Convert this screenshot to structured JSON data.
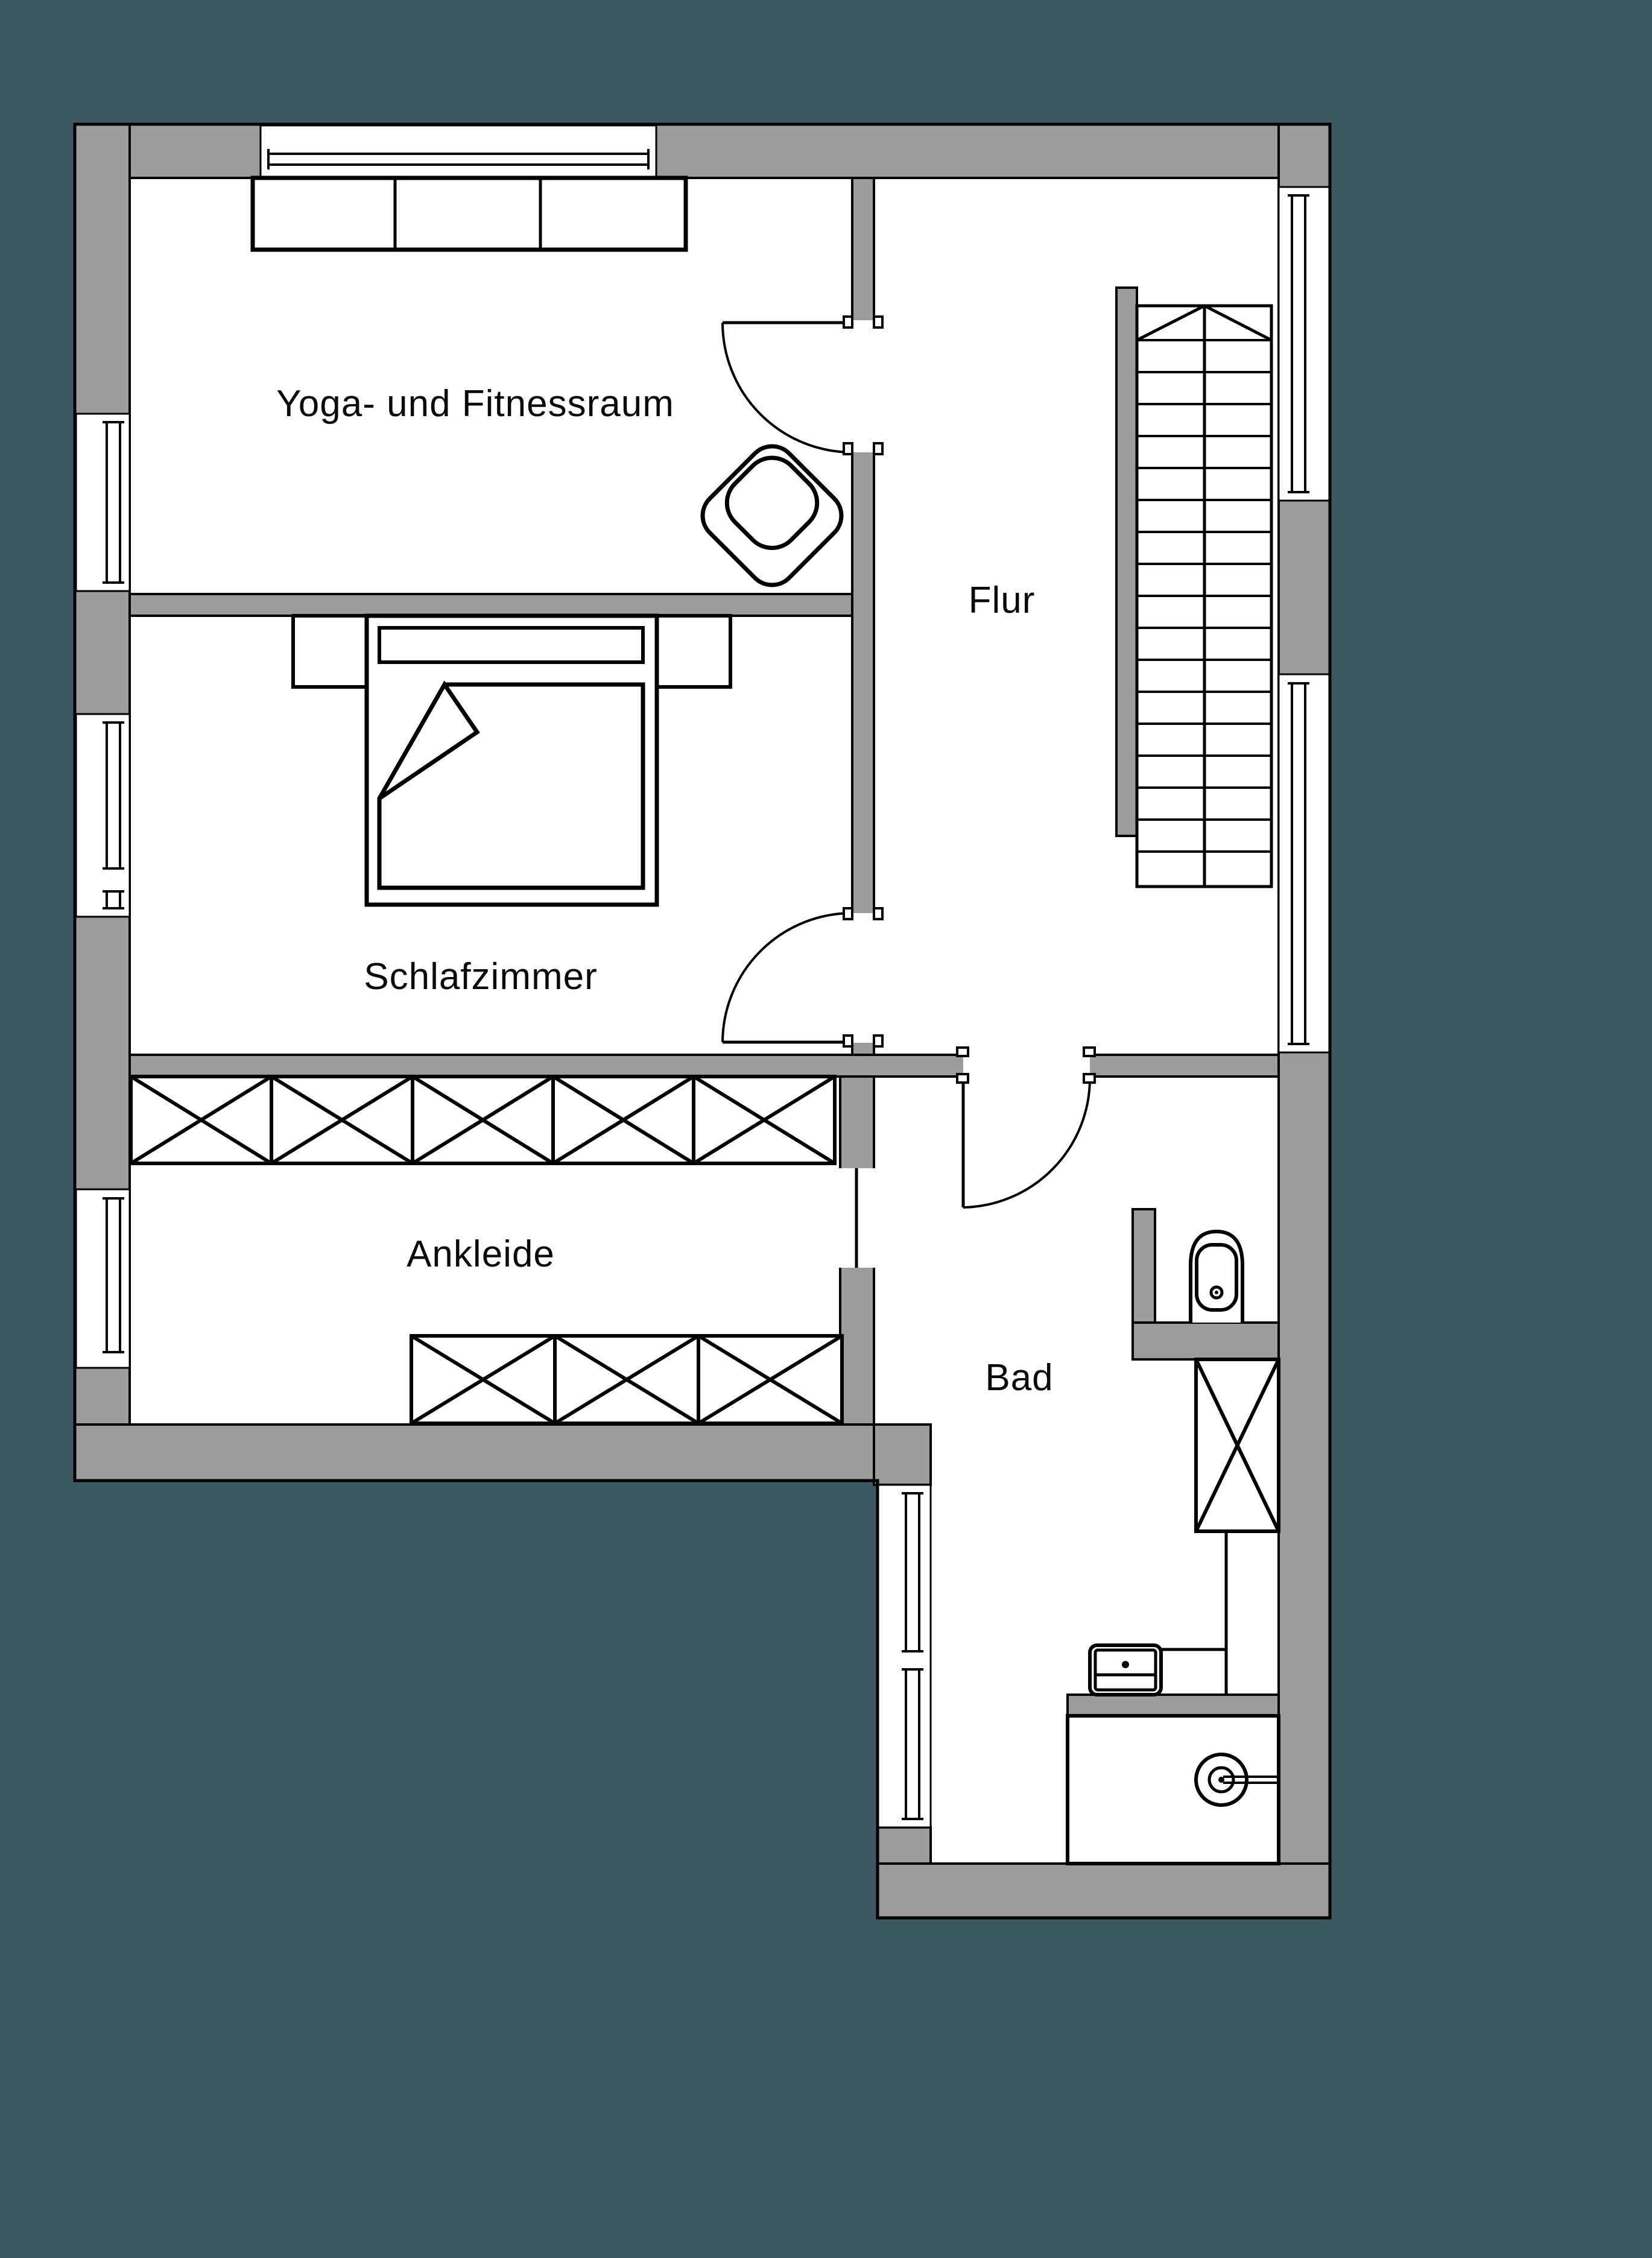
{
  "colors": {
    "background": "#3D5964",
    "wall_gray": "#9C9C9B",
    "line_black": "#000000",
    "floor_white": "#FFFFFF"
  },
  "rooms": {
    "yoga": {
      "label": "Yoga- und Fitnessraum"
    },
    "flur": {
      "label": "Flur"
    },
    "schlafzimmer": {
      "label": "Schlafzimmer"
    },
    "ankleide": {
      "label": "Ankleide"
    },
    "bad": {
      "label": "Bad"
    }
  }
}
